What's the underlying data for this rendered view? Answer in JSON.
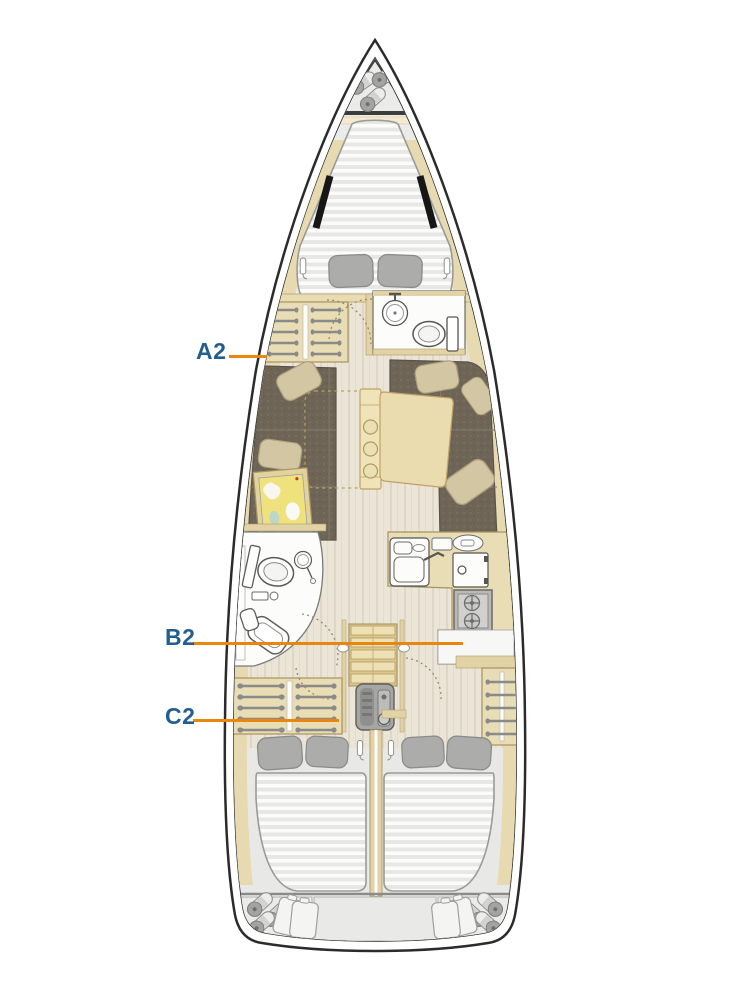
{
  "plan": {
    "type": "sailboat-interior-deck-plan",
    "labels": [
      {
        "id": "A2",
        "text_color": "#235e91",
        "line_color": "#e8860e"
      },
      {
        "id": "B2",
        "text_color": "#235e91",
        "line_color": "#e8860e"
      },
      {
        "id": "C2",
        "text_color": "#235e91",
        "line_color": "#e8860e"
      }
    ],
    "palette": {
      "hull_outline": "#2b2b2b",
      "deck": "#f0f0ee",
      "wood_trim": "#e7d9b0",
      "wood_edge": "#a8935f",
      "floor_planks": "#ebe5d8",
      "upholstery": "#6e6557",
      "cushion_beige": "#d3c6a3",
      "mattress": "#e7e7e5",
      "pillow_gray": "#acacaa",
      "fixture_white": "#fcfcfb",
      "appliance_gray": "#b9b9b7"
    }
  }
}
